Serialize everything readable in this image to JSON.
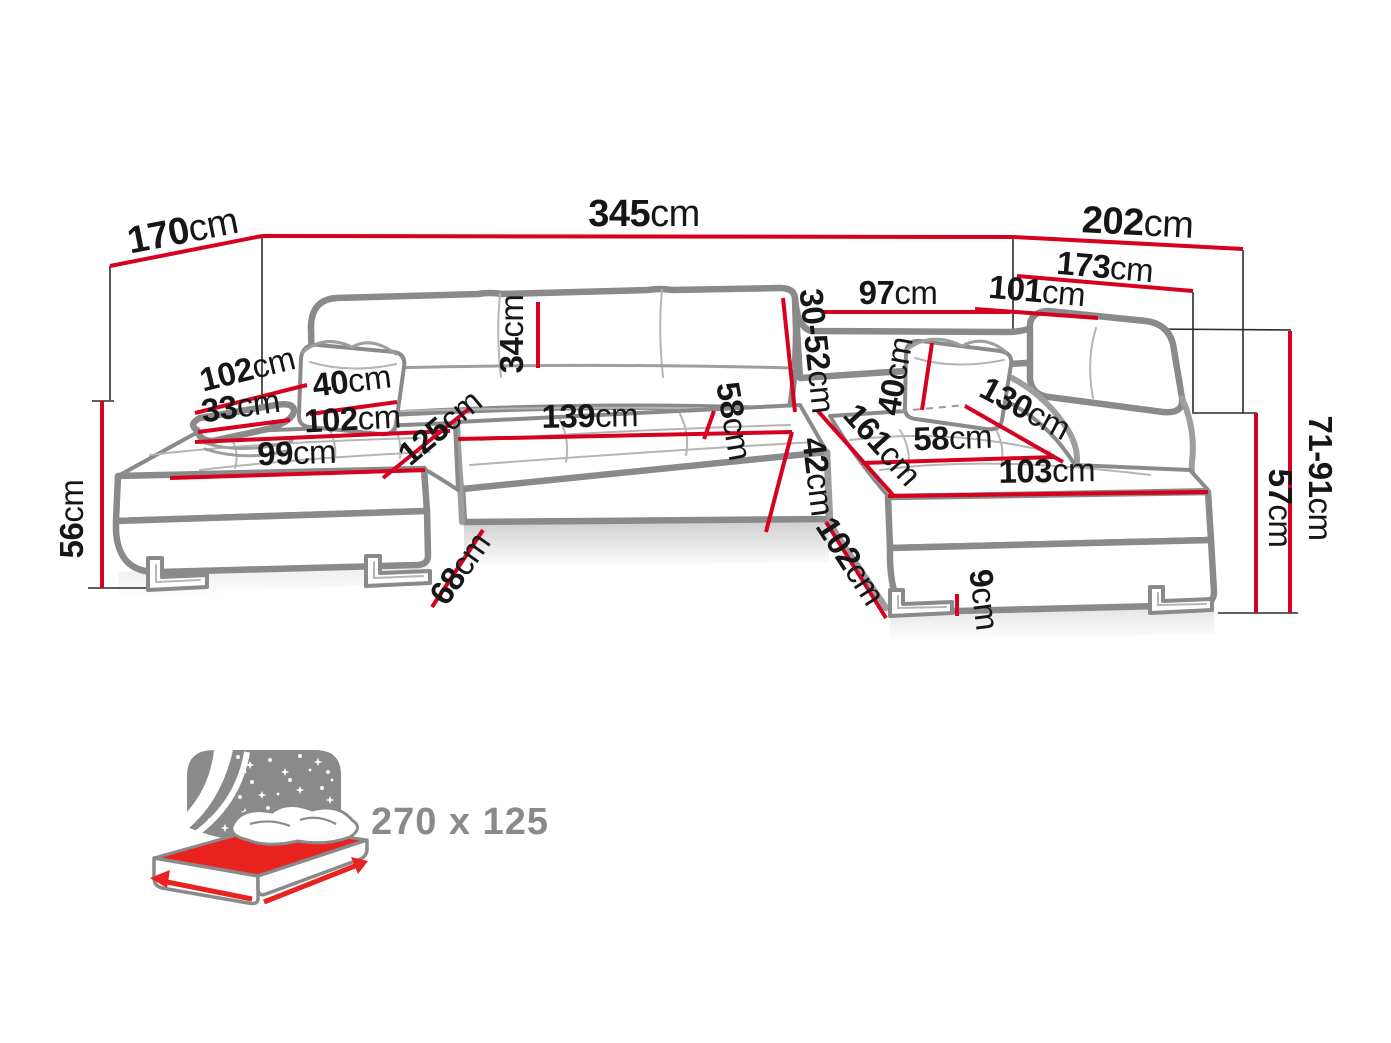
{
  "diagram_title": "sofa-dimension-diagram",
  "colors": {
    "dimension_line_red": "#d6001f",
    "sofa_outline_gray": "#8a8a8a",
    "label_black": "#161616",
    "connector_black": "#2b2b2b",
    "icon_gray": "#8a8a8a",
    "icon_red": "#e8231f",
    "background": "#ffffff"
  },
  "dims": {
    "d170": {
      "num": "170",
      "unit": "cm"
    },
    "d345": {
      "num": "345",
      "unit": "cm"
    },
    "d202": {
      "num": "202",
      "unit": "cm"
    },
    "d173": {
      "num": "173",
      "unit": "cm"
    },
    "d97": {
      "num": "97",
      "unit": "cm"
    },
    "d101": {
      "num": "101",
      "unit": "cm"
    },
    "d34": {
      "num": "34",
      "unit": "cm"
    },
    "d3052": {
      "num": "30-52",
      "unit": "cm"
    },
    "d102a": {
      "num": "102",
      "unit": "cm"
    },
    "d40l": {
      "num": "40",
      "unit": "cm"
    },
    "d33": {
      "num": "33",
      "unit": "cm"
    },
    "d102b": {
      "num": "102",
      "unit": "cm"
    },
    "d99": {
      "num": "99",
      "unit": "cm"
    },
    "d56": {
      "num": "56",
      "unit": "cm"
    },
    "d125": {
      "num": "125",
      "unit": "cm"
    },
    "d139": {
      "num": "139",
      "unit": "cm"
    },
    "d58c": {
      "num": "58",
      "unit": "cm"
    },
    "d42": {
      "num": "42",
      "unit": "cm"
    },
    "d161": {
      "num": "161",
      "unit": "cm"
    },
    "d40r": {
      "num": "40",
      "unit": "cm"
    },
    "d58r": {
      "num": "58",
      "unit": "cm"
    },
    "d130": {
      "num": "130",
      "unit": "cm"
    },
    "d103": {
      "num": "103",
      "unit": "cm"
    },
    "d102c": {
      "num": "102",
      "unit": "cm"
    },
    "d9": {
      "num": "9",
      "unit": "cm"
    },
    "d68": {
      "num": "68",
      "unit": "cm"
    },
    "d7191": {
      "num": "71-91",
      "unit": "cm"
    },
    "d57": {
      "num": "57",
      "unit": "cm"
    }
  },
  "sleeping_area": {
    "size": "270 x 125"
  }
}
